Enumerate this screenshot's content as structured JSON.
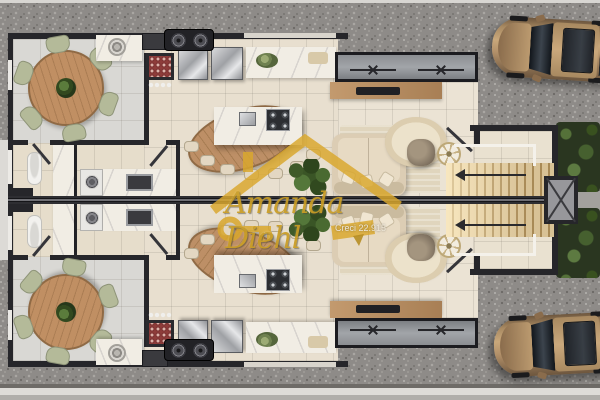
{
  "scene": {
    "title": "Residential duplex ground-floor plan - 3D top view render",
    "units": [
      "upper-unit",
      "lower-unit"
    ],
    "rooms_per_unit": [
      "dining-room",
      "bathroom",
      "laundry",
      "kitchen",
      "living-room",
      "entry-porch",
      "staircase"
    ],
    "furniture": [
      "round-dining-table",
      "dining-chairs-x6",
      "corner-sink-counter",
      "wine-rack",
      "refrigerators",
      "kitchen-counter-with-bowl",
      "island-with-cooktop-and-sink",
      "wood-island-table-with-stools",
      "tv-sideboard",
      "sofa-with-pillows",
      "round-rug",
      "armchair",
      "round-side-table",
      "potted-plant",
      "toilet",
      "vanity-sink",
      "washing-machine",
      "laundry-counter-sink",
      "illuminated-stairs"
    ],
    "exterior": [
      "gravel-driveway",
      "sidewalks",
      "parked-car-upper",
      "parked-car-lower",
      "hedge-trees",
      "ac-condenser-pads",
      "shaft-with-x-marking",
      "side-path"
    ]
  },
  "watermark": {
    "brand_script": "Amanda Diehl",
    "license": "Creci 22.915",
    "logo": "gold-roof-and-key-logo"
  },
  "colors": {
    "gravel": "#8e8b88",
    "wall": "#26262a",
    "floor_gray": "#d9d8d4",
    "floor_beige": "#e8dfcf",
    "floor_cream": "#ebe3d4",
    "marble": "#f1ede4",
    "wood": "#bd8f66",
    "chair_sage": "#b4ba99",
    "sofa_cream": "#dccdb4",
    "wine_red": "#8e3c3a",
    "stair_glow": "#edd9ad",
    "car_bronze": "#c9a87b",
    "plant_green": "#3a5526",
    "watermark_gold": "#d9a72e"
  }
}
